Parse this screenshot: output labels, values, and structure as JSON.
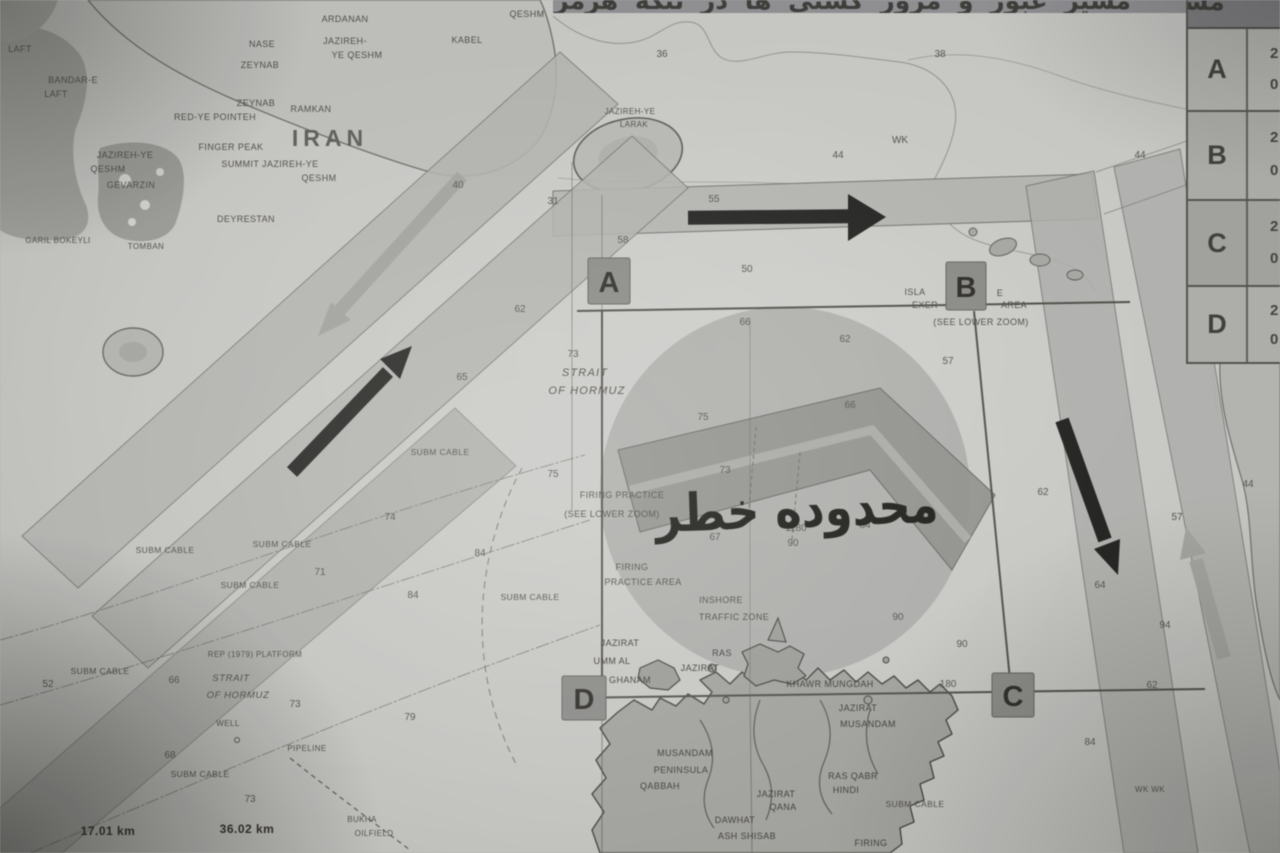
{
  "banner": {
    "title": "مسیر عبور و مرور کشتی ها در تنگه هرمز"
  },
  "table": {
    "rows": [
      {
        "letter": "A",
        "frag_top": "2",
        "frag_bottom": "0"
      },
      {
        "letter": "B",
        "frag_top": "2",
        "frag_bottom": "0"
      },
      {
        "letter": "C",
        "frag_top": "2",
        "frag_bottom": "0"
      },
      {
        "letter": "D",
        "frag_top": "2",
        "frag_bottom": "0"
      }
    ]
  },
  "map": {
    "danger_label": "محدوده خطر",
    "corner_markers": [
      {
        "id": "A",
        "x": 588,
        "y": 258
      },
      {
        "id": "B",
        "x": 946,
        "y": 262
      },
      {
        "id": "C",
        "x": 992,
        "y": 673
      },
      {
        "id": "D",
        "x": 562,
        "y": 676
      }
    ],
    "labels": [
      {
        "t": "LAFT",
        "x": 20,
        "y": 52
      },
      {
        "t": "BANDAR-E",
        "x": 73,
        "y": 83
      },
      {
        "t": "LAFT",
        "x": 56,
        "y": 97
      },
      {
        "t": "ARDANAN",
        "x": 345,
        "y": 22
      },
      {
        "t": "NASE",
        "x": 262,
        "y": 47
      },
      {
        "t": "ZEYNAB",
        "x": 260,
        "y": 68
      },
      {
        "t": "ZEYNAB",
        "x": 256,
        "y": 106
      },
      {
        "t": "RAMKAN",
        "x": 311,
        "y": 112
      },
      {
        "t": "RED-YE POINTEH",
        "x": 215,
        "y": 120
      },
      {
        "t": "JAZIREH-",
        "x": 345,
        "y": 44
      },
      {
        "t": "YE QESHM",
        "x": 357,
        "y": 58
      },
      {
        "t": "KABEL",
        "x": 467,
        "y": 43
      },
      {
        "t": "QESHM",
        "x": 527,
        "y": 17
      },
      {
        "t": "IRAN",
        "x": 330,
        "y": 146,
        "c": "iran"
      },
      {
        "t": "FINGER PEAK",
        "x": 231,
        "y": 150
      },
      {
        "t": "SUMMIT JAZIREH-YE",
        "x": 270,
        "y": 167
      },
      {
        "t": "QESHM",
        "x": 319,
        "y": 181
      },
      {
        "t": "JAZIREH-YE",
        "x": 125,
        "y": 158
      },
      {
        "t": "QESHM",
        "x": 108,
        "y": 172
      },
      {
        "t": "GEVARZIN",
        "x": 131,
        "y": 188
      },
      {
        "t": "DEYRESTAN",
        "x": 246,
        "y": 222
      },
      {
        "t": "GARIL BOKEYLI",
        "x": 58,
        "y": 243,
        "c": "xs"
      },
      {
        "t": "TOMBAN",
        "x": 146,
        "y": 249,
        "c": "xs"
      },
      {
        "t": "JAZIREH-YE",
        "x": 630,
        "y": 114,
        "c": "xs"
      },
      {
        "t": "LARAK",
        "x": 634,
        "y": 127,
        "c": "xs"
      },
      {
        "t": "STRAIT",
        "x": 585,
        "y": 376,
        "c": "it-m"
      },
      {
        "t": "OF HORMUZ",
        "x": 587,
        "y": 394,
        "c": "it-m"
      },
      {
        "t": "FIRING PRACTICE",
        "x": 622,
        "y": 498
      },
      {
        "t": "(SEE LOWER ZOOM)",
        "x": 612,
        "y": 517
      },
      {
        "t": "FIRING",
        "x": 632,
        "y": 570
      },
      {
        "t": "PRACTICE AREA",
        "x": 643,
        "y": 585
      },
      {
        "t": "INSHORE",
        "x": 721,
        "y": 603
      },
      {
        "t": "TRAFFIC ZONE",
        "x": 734,
        "y": 620
      },
      {
        "t": "ISLA",
        "x": 915,
        "y": 295
      },
      {
        "t": "E",
        "x": 1000,
        "y": 296
      },
      {
        "t": "EXER",
        "x": 925,
        "y": 308
      },
      {
        "t": "AREA",
        "x": 1014,
        "y": 308
      },
      {
        "t": "(SEE LOWER ZOOM)",
        "x": 981,
        "y": 325
      },
      {
        "t": "SUBM CABLE",
        "x": 440,
        "y": 455,
        "c": "cab"
      },
      {
        "t": "SUBM CABLE",
        "x": 282,
        "y": 547,
        "c": "cab"
      },
      {
        "t": "SUBM CABLE",
        "x": 250,
        "y": 588,
        "c": "cab"
      },
      {
        "t": "SUBM CABLE",
        "x": 165,
        "y": 553,
        "c": "cab"
      },
      {
        "t": "SUBM CABLE",
        "x": 100,
        "y": 674,
        "c": "cab"
      },
      {
        "t": "SUBM CABLE",
        "x": 530,
        "y": 600,
        "c": "cab"
      },
      {
        "t": "SUBM CABLE",
        "x": 200,
        "y": 777,
        "c": "cab"
      },
      {
        "t": "SUBM CABLE",
        "x": 915,
        "y": 807,
        "c": "cab"
      },
      {
        "t": "REP (1979) PLATFORM",
        "x": 255,
        "y": 657,
        "c": "xs"
      },
      {
        "t": "STRAIT",
        "x": 231,
        "y": 681,
        "c": "it-s"
      },
      {
        "t": "OF HORMUZ",
        "x": 238,
        "y": 698,
        "c": "it-s"
      },
      {
        "t": "WELL",
        "x": 228,
        "y": 726,
        "c": "xs"
      },
      {
        "t": "PIPELINE",
        "x": 307,
        "y": 751,
        "c": "xs"
      },
      {
        "t": "BUKHA",
        "x": 362,
        "y": 822,
        "c": "xs"
      },
      {
        "t": "OILFIELD",
        "x": 374,
        "y": 836,
        "c": "xs"
      },
      {
        "t": "17.01 km",
        "x": 108,
        "y": 835,
        "c": "dist"
      },
      {
        "t": "36.02 km",
        "x": 247,
        "y": 833,
        "c": "dist"
      },
      {
        "t": "JAZIRAT",
        "x": 620,
        "y": 646,
        "c": "dk"
      },
      {
        "t": "UMM AL",
        "x": 612,
        "y": 664,
        "c": "dk"
      },
      {
        "t": "GHANAM",
        "x": 630,
        "y": 683,
        "c": "dk"
      },
      {
        "t": "RAS",
        "x": 722,
        "y": 656,
        "c": "dk"
      },
      {
        "t": "JAZIRAT",
        "x": 700,
        "y": 671,
        "c": "dk"
      },
      {
        "t": "KHAWR MUNGDAH",
        "x": 830,
        "y": 687,
        "c": "dk"
      },
      {
        "t": "JAZIRAT",
        "x": 858,
        "y": 711,
        "c": "dk"
      },
      {
        "t": "MUSANDAM",
        "x": 868,
        "y": 727,
        "c": "dk"
      },
      {
        "t": "MUSANDAM",
        "x": 685,
        "y": 756,
        "c": "dk"
      },
      {
        "t": "PENINSULA",
        "x": 681,
        "y": 773,
        "c": "dk"
      },
      {
        "t": "QABBAH",
        "x": 660,
        "y": 789,
        "c": "dk"
      },
      {
        "t": "JAZIRAT",
        "x": 776,
        "y": 797,
        "c": "dk"
      },
      {
        "t": "QANA",
        "x": 783,
        "y": 810,
        "c": "dk"
      },
      {
        "t": "RAS QABR",
        "x": 853,
        "y": 779,
        "c": "dk"
      },
      {
        "t": "HINDI",
        "x": 846,
        "y": 793,
        "c": "dk"
      },
      {
        "t": "DAWHAT",
        "x": 735,
        "y": 823,
        "c": "dk"
      },
      {
        "t": "ASH SHISAB",
        "x": 747,
        "y": 839,
        "c": "dk"
      },
      {
        "t": "FIRING",
        "x": 871,
        "y": 846,
        "c": "dk"
      },
      {
        "t": "WK WK",
        "x": 1150,
        "y": 792,
        "c": "xs"
      }
    ],
    "soundings": [
      {
        "v": "36",
        "x": 662,
        "y": 57
      },
      {
        "v": "38",
        "x": 940,
        "y": 57
      },
      {
        "v": "44",
        "x": 838,
        "y": 158
      },
      {
        "v": "WK",
        "x": 900,
        "y": 143
      },
      {
        "v": "44",
        "x": 1140,
        "y": 158
      },
      {
        "v": "WK",
        "x": 1205,
        "y": 150
      },
      {
        "v": "31",
        "x": 553,
        "y": 204
      },
      {
        "v": "55",
        "x": 714,
        "y": 202
      },
      {
        "v": "58",
        "x": 623,
        "y": 243
      },
      {
        "v": "50",
        "x": 747,
        "y": 272
      },
      {
        "v": "40",
        "x": 458,
        "y": 188
      },
      {
        "v": "62",
        "x": 520,
        "y": 312
      },
      {
        "v": "65",
        "x": 462,
        "y": 380
      },
      {
        "v": "73",
        "x": 573,
        "y": 357
      },
      {
        "v": "66",
        "x": 745,
        "y": 325
      },
      {
        "v": "62",
        "x": 845,
        "y": 342
      },
      {
        "v": "57",
        "x": 948,
        "y": 364
      },
      {
        "v": "66",
        "x": 850,
        "y": 408
      },
      {
        "v": "75",
        "x": 703,
        "y": 420
      },
      {
        "v": "73",
        "x": 725,
        "y": 473
      },
      {
        "v": "1180",
        "x": 796,
        "y": 531
      },
      {
        "v": "90",
        "x": 793,
        "y": 546
      },
      {
        "v": "84",
        "x": 865,
        "y": 528
      },
      {
        "v": "67",
        "x": 715,
        "y": 540
      },
      {
        "v": "90",
        "x": 898,
        "y": 620
      },
      {
        "v": "90",
        "x": 962,
        "y": 647
      },
      {
        "v": "180",
        "x": 948,
        "y": 687
      },
      {
        "v": "75",
        "x": 553,
        "y": 477
      },
      {
        "v": "74",
        "x": 390,
        "y": 520
      },
      {
        "v": "71",
        "x": 320,
        "y": 575
      },
      {
        "v": "84",
        "x": 480,
        "y": 556
      },
      {
        "v": "84",
        "x": 413,
        "y": 598
      },
      {
        "v": "52",
        "x": 48,
        "y": 687
      },
      {
        "v": "66",
        "x": 174,
        "y": 683
      },
      {
        "v": "73",
        "x": 295,
        "y": 707
      },
      {
        "v": "68",
        "x": 170,
        "y": 758
      },
      {
        "v": "73",
        "x": 250,
        "y": 802
      },
      {
        "v": "79",
        "x": 410,
        "y": 720
      },
      {
        "v": "62",
        "x": 1043,
        "y": 495
      },
      {
        "v": "57",
        "x": 1177,
        "y": 520
      },
      {
        "v": "44",
        "x": 1248,
        "y": 487
      },
      {
        "v": "64",
        "x": 1100,
        "y": 588
      },
      {
        "v": "94",
        "x": 1165,
        "y": 628
      },
      {
        "v": "62",
        "x": 1152,
        "y": 688
      },
      {
        "v": "84",
        "x": 1090,
        "y": 745
      }
    ]
  }
}
